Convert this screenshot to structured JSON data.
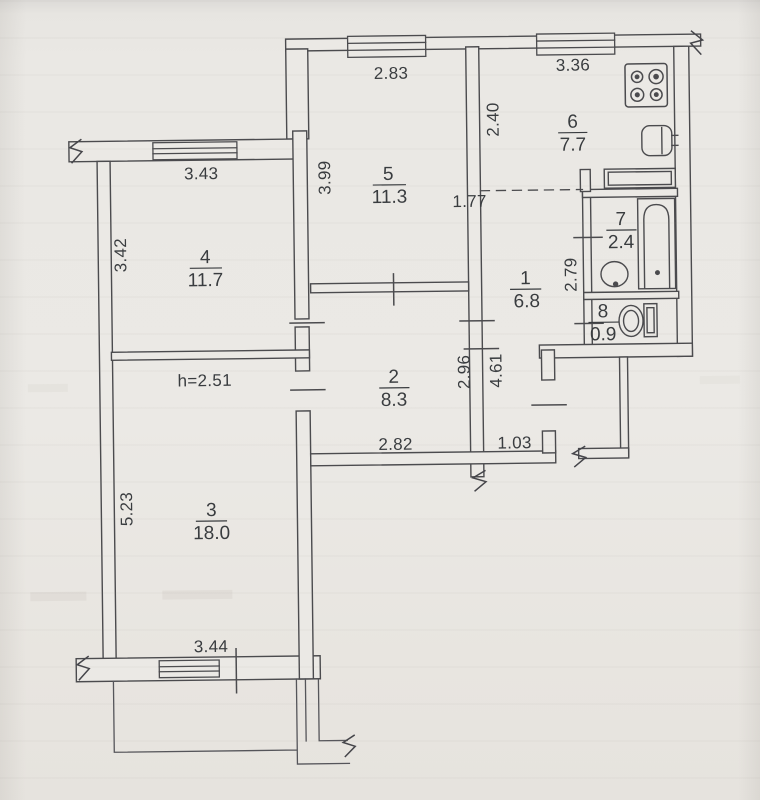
{
  "document": {
    "kind": "apartment floor plan (BTI technical drawing)",
    "colors": {
      "paper": "#eae8e4",
      "line": "#4b4b4e",
      "text": "#393c3f"
    }
  },
  "floorplan": {
    "rooms": [
      {
        "number": "1",
        "area": "6.8"
      },
      {
        "number": "2",
        "area": "8.3"
      },
      {
        "number": "3",
        "area": "18.0"
      },
      {
        "number": "4",
        "area": "11.7"
      },
      {
        "number": "5",
        "area": "11.3"
      },
      {
        "number": "6",
        "area": "7.7"
      },
      {
        "number": "7",
        "area": "2.4"
      },
      {
        "number": "8",
        "area": "0.9"
      }
    ],
    "dimensions": {
      "room5_width": "2.83",
      "kitchen_width": "3.36",
      "kitchen_depth": "2.40",
      "room5_depth": "3.99",
      "kitchen_passage": "1.77",
      "room4_width": "3.43",
      "room4_depth": "3.42",
      "hall_right": "2.79",
      "room2_depth": "2.96",
      "hall_length": "4.61",
      "room2_width": "2.82",
      "entry_width": "1.03",
      "ceiling_height": "h=2.51",
      "room3_depth": "5.23",
      "room3_width": "3.44"
    },
    "fixtures": {
      "stove": "stove-icon",
      "kitchen_sink": "kitchen-sink-icon",
      "bathtub": "bathtub-icon",
      "washbasin": "washbasin-icon",
      "toilet": "toilet-icon"
    }
  }
}
